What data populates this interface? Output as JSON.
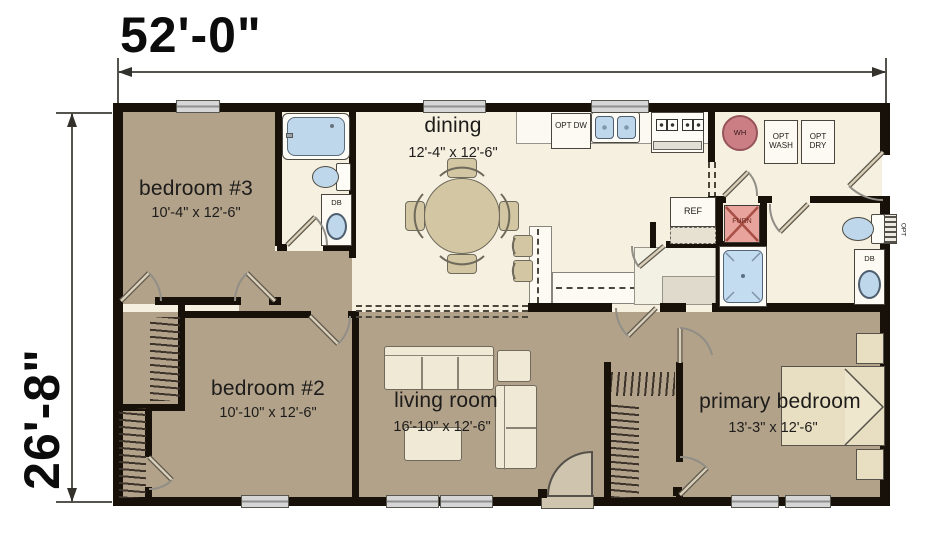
{
  "plan": {
    "width_dim": "52'-0\"",
    "height_dim": "26'-8\"",
    "rooms": [
      {
        "name": "bedroom #3",
        "size": "10'-4\" x 12'-6\""
      },
      {
        "name": "dining",
        "size": "12'-4\" x 12'-6\""
      },
      {
        "name": "bedroom #2",
        "size": "10'-10\" x 12'-6\""
      },
      {
        "name": "living room",
        "size": "16'-10\" x 12'-6\""
      },
      {
        "name": "primary bedroom",
        "size": "13'-3\" x 12'-6\""
      }
    ],
    "labels": {
      "wh": "WH",
      "furn": "FURN",
      "ref": "REF",
      "db": "DB",
      "opt_dw": "OPT DW",
      "opt_wash": "OPT WASH",
      "opt_dry": "OPT DRY",
      "opt": "OPT"
    },
    "colors": {
      "room_tan": "#b2a28a",
      "room_cream": "#f6f0e0",
      "wall": "#18110a",
      "fixture_blue": "#bed7ea",
      "wh_pink": "#cb7f85",
      "furn_red": "#e8a39c"
    }
  }
}
